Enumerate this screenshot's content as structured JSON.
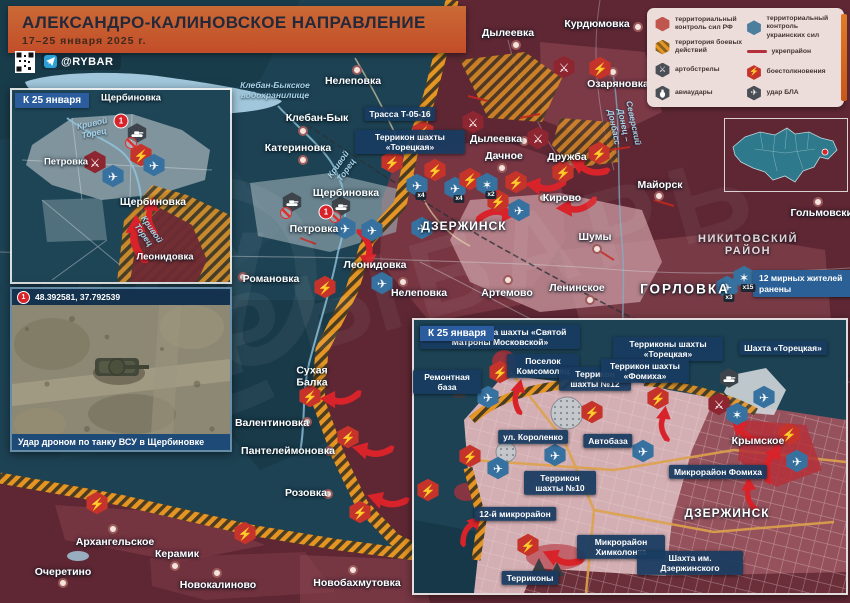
{
  "header": {
    "title": "АЛЕКСАНДРО-КАЛИНОВСКОЕ НАПРАВЛЕНИЕ",
    "date_range": "17–25 января 2025 г.",
    "channel": "@RYBAR"
  },
  "legend": {
    "rf_control": "территориальный контроль сил РФ",
    "ua_control": "территориальный контроль украинских сил",
    "combat_zone": "территория боевых действий",
    "fortified": "укрепрайон",
    "shelling": "артобстрелы",
    "clashes": "боестолкновения",
    "airstrikes": "авиаудары",
    "uav_strike": "удар БЛА"
  },
  "icons": {
    "clash": "⚡",
    "artillery": "⚔",
    "uav": "✈",
    "explosion": "✶"
  },
  "inset_shcherbinovka": {
    "title": "К 25 января",
    "marker": "1",
    "labels": {
      "s_top": "Щербиновка",
      "petrovka": "Петровка",
      "s_mid": "Щербиновка",
      "leonidovka": "Леонидовка",
      "river": "Кривой Торец"
    }
  },
  "inset_photo": {
    "marker": "1",
    "coordinates": "48.392581, 37.792539",
    "caption": "Удар дроном по танку ВСУ в Щербиновке"
  },
  "main_map": {
    "settlements": [
      "Курдюмовка",
      "Дылеевка",
      "Нелеповка",
      "Озаряновка",
      "Клебан-Бык",
      "Катериновка",
      "Дылеевка",
      "Дачное",
      "Дружба",
      "Кирово",
      "Майорск",
      "Шумы",
      "Ленинское",
      "Гольмовский",
      "Артемово",
      "Щербиновка",
      "Петровка",
      "Леонидовка",
      "Романовка",
      "Нелеповка",
      "Сухая Балка",
      "Валентиновка",
      "Пантелеймоновка",
      "Розовка",
      "Архангельское",
      "Керамик",
      "Очеретино",
      "Новокалиново",
      "Новобахмутовка"
    ],
    "cities": {
      "dzerzhinsk": "ДЗЕРЖИНСК",
      "gorlovka": "ГОРЛОВКА",
      "nikitovsky": "НИКИТОВСКИЙ РАЙОН"
    },
    "water": {
      "reservoir": "Клебан-Быкское водохранилище",
      "river": "Кривой Торец",
      "canal": "Северский Донец – Донбасс"
    },
    "road_label": "Трасса Т-05-16",
    "mine_label": "Террикон шахты «Торецкая»",
    "casualty_badge": "12 мирных жителей ранены",
    "marker": "1",
    "multipliers": [
      "х4",
      "х4",
      "х2",
      "х3",
      "х15"
    ]
  },
  "inset_dzerzhinsk": {
    "title": "К 25 января",
    "city": "ДЗЕРЖИНСК",
    "settlement": "Крымское",
    "sites": [
      "Промплощадка шахты «Святой Матроны Московской»",
      "Поселок Комсомолец",
      "Терриконы шахты «Торецкая»",
      "Шахта «Торецкая»",
      "Ремонтная база",
      "Террикон шахты №12",
      "Террикон шахты «Фомиха»",
      "ул. Короленко",
      "Автобаза",
      "Микрорайон Фомиха",
      "Террикон шахты №10",
      "12-й микрорайон",
      "Микрорайон Химколонка",
      "Шахта им. Дзержинского",
      "Терриконы"
    ]
  },
  "watermark": {
    "text": "РЫБАРЬ",
    "at": "@"
  }
}
